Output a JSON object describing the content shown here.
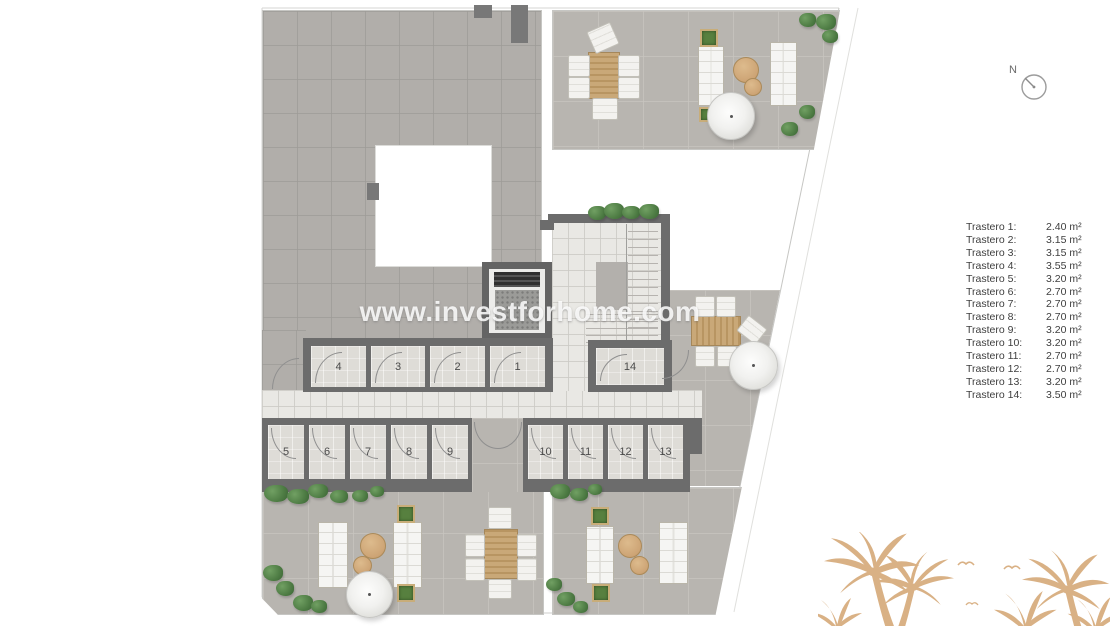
{
  "title": "storage-rooms-floor-plan",
  "watermark": {
    "text": "www.investforhome.com"
  },
  "north_indicator": {
    "label": "N",
    "icon": "north-compass-icon"
  },
  "plan": {
    "room_labels": [
      "1",
      "2",
      "3",
      "4",
      "5",
      "6",
      "7",
      "8",
      "9",
      "10",
      "11",
      "12",
      "13",
      "14"
    ]
  },
  "legend": {
    "items": [
      {
        "name": "Trastero 1:",
        "area": "2.40 m²"
      },
      {
        "name": "Trastero 2:",
        "area": "3.15 m²"
      },
      {
        "name": "Trastero 3:",
        "area": "3.15 m²"
      },
      {
        "name": "Trastero 4:",
        "area": "3.55 m²"
      },
      {
        "name": "Trastero 5:",
        "area": "3.20 m²"
      },
      {
        "name": "Trastero 6:",
        "area": "2.70 m²"
      },
      {
        "name": "Trastero 7:",
        "area": "2.70 m²"
      },
      {
        "name": "Trastero 8:",
        "area": "2.70 m²"
      },
      {
        "name": "Trastero 9:",
        "area": "3.20 m²"
      },
      {
        "name": "Trastero 10:",
        "area": "3.20 m²"
      },
      {
        "name": "Trastero 11:",
        "area": "2.70 m²"
      },
      {
        "name": "Trastero 12:",
        "area": "2.70 m²"
      },
      {
        "name": "Trastero 13:",
        "area": "3.20 m²"
      },
      {
        "name": "Trastero 14:",
        "area": "3.50 m²"
      }
    ]
  },
  "colors": {
    "palm_tan": "#d9b185",
    "bush_green": "#4e7c44",
    "wood_table": "#c5a173",
    "wall_dark": "#6c6c6c",
    "roof_gray": "#b1aeaa",
    "terrace_gray": "#b8b5b0",
    "paving_light": "#e9e8e4",
    "legend_text": "#3e3e3e"
  }
}
